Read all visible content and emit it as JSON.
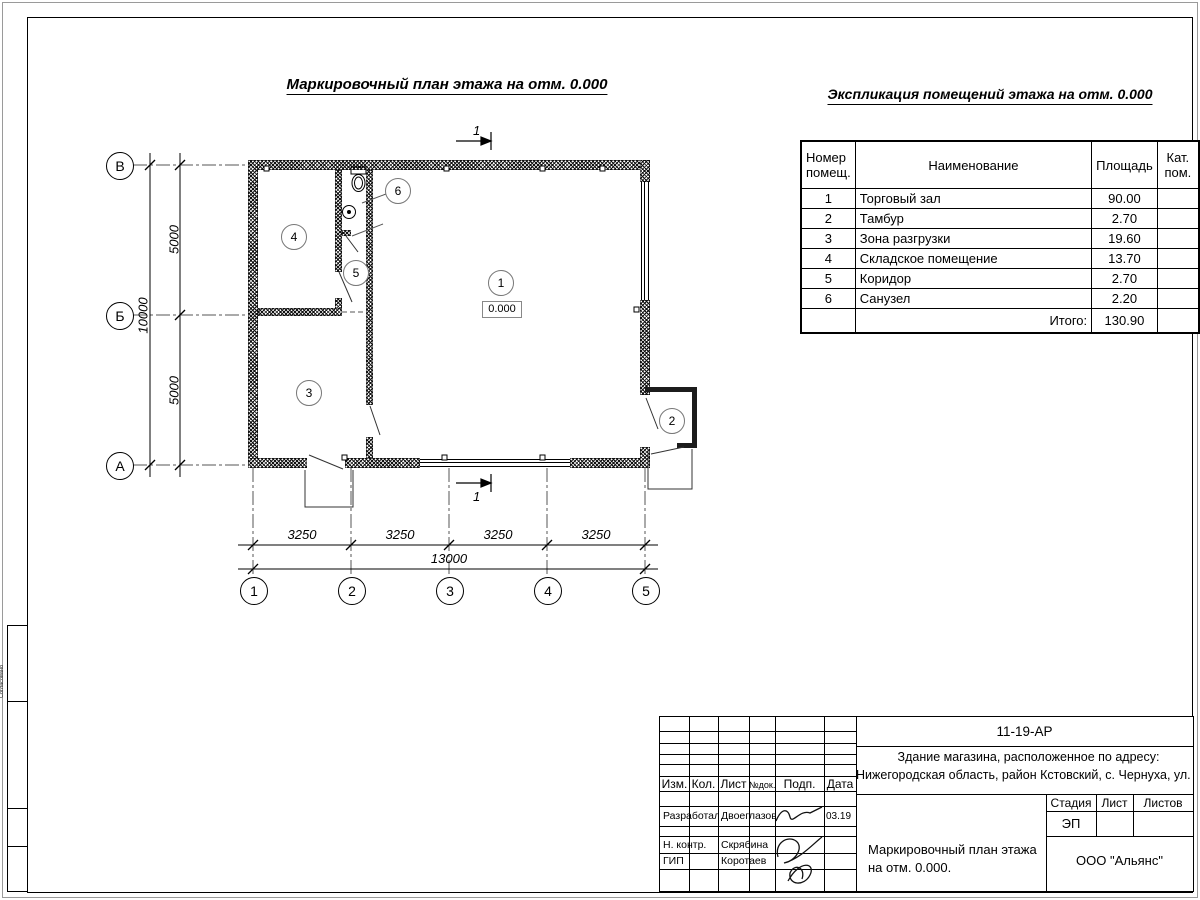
{
  "page": {
    "plan_title": "Маркировочный план этажа на отм. 0.000",
    "explication_title": "Экспликация помещений этажа на отм. 0.000"
  },
  "plan": {
    "level_mark": "0.000",
    "section_mark": "1",
    "axes_bottom": [
      "1",
      "2",
      "3",
      "4",
      "5"
    ],
    "axes_left": [
      "В",
      "Б",
      "А"
    ],
    "room_markers": [
      "1",
      "2",
      "3",
      "4",
      "5",
      "6"
    ],
    "dims": {
      "d1": "3250",
      "d2": "3250",
      "d3": "3250",
      "d4": "3250",
      "total": "13000",
      "v1": "5000",
      "v2": "5000",
      "vtotal": "10000"
    }
  },
  "explication": {
    "header": {
      "num_l1": "Номер",
      "num_l2": "помещ.",
      "name": "Наименование",
      "area": "Площадь",
      "cat_l1": "Кат.",
      "cat_l2": "пом."
    },
    "rows": [
      {
        "num": "1",
        "name": "Торговый зал",
        "area": "90.00"
      },
      {
        "num": "2",
        "name": "Тамбур",
        "area": "2.70"
      },
      {
        "num": "3",
        "name": "Зона разгрузки",
        "area": "19.60"
      },
      {
        "num": "4",
        "name": "Складское помещение",
        "area": "13.70"
      },
      {
        "num": "5",
        "name": "Коридор",
        "area": "2.70"
      },
      {
        "num": "6",
        "name": "Санузел",
        "area": "2.20"
      }
    ],
    "total_label": "Итого:",
    "total_value": "130.90"
  },
  "title_block": {
    "doc_number": "11-19-АР",
    "address_line1": "Здание магазина, расположенное по адресу:",
    "address_line2": "Нижегородская область, район Кстовский, с. Чернуха, ул. Нов",
    "col_izm": "Изм.",
    "col_kol": "Кол.",
    "col_list": "Лист",
    "col_ndok": "№док.",
    "col_podp": "Подп.",
    "col_data": "Дата",
    "stage_label": "Стадия",
    "sheet_label": "Лист",
    "sheets_label": "Листов",
    "stage_value": "ЭП",
    "drawing_title_line1": "Маркировочный план этажа",
    "drawing_title_line2": "на отм. 0.000.",
    "company": "ООО \"Альянс\"",
    "rows": [
      {
        "role": "Разработал",
        "name": "Двоеглазов",
        "date": "03.19"
      },
      {
        "role": "Н. контр.",
        "name": "Скрябина",
        "date": ""
      },
      {
        "role": "ГИП",
        "name": "Коротаев",
        "date": ""
      }
    ]
  },
  "left_margin": {
    "box1": "Согласовано"
  }
}
